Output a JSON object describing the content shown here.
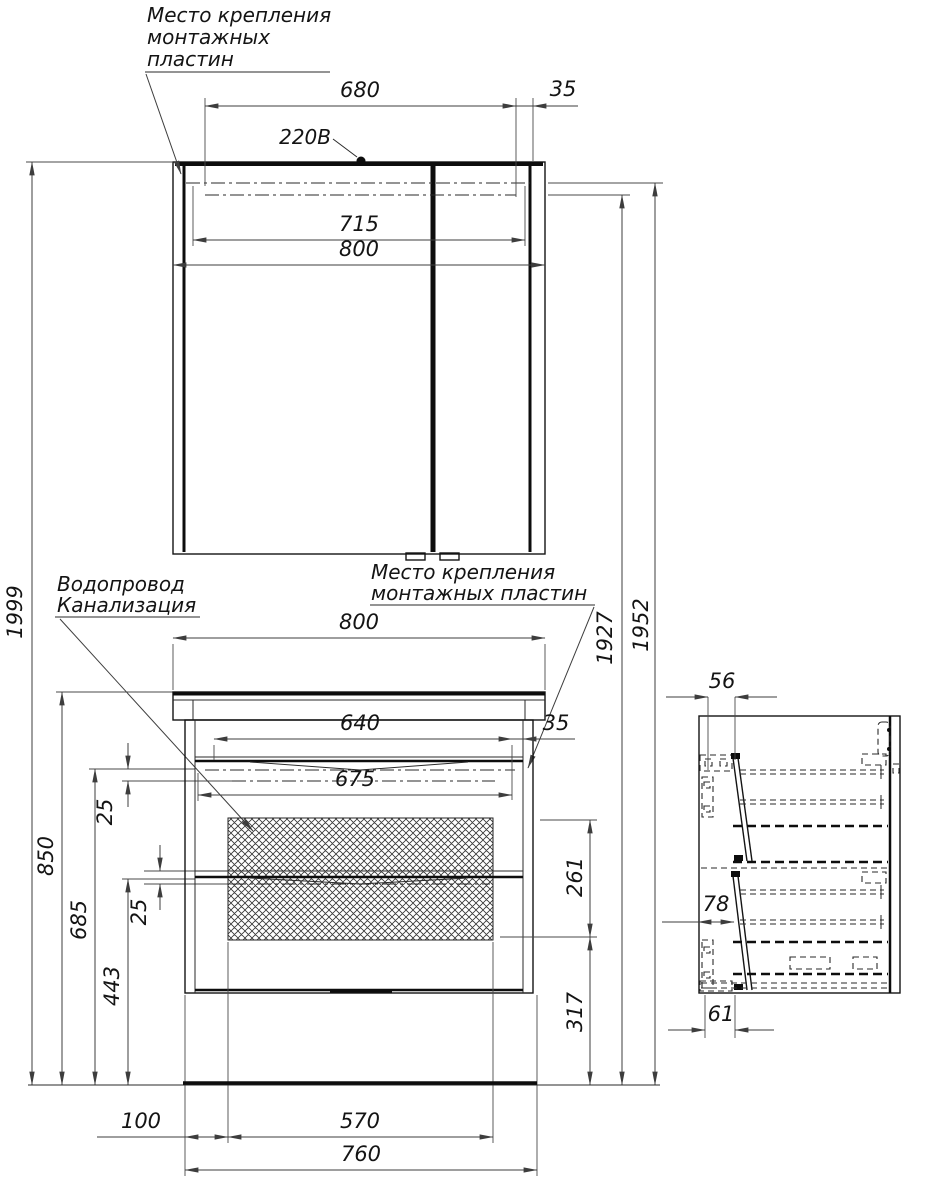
{
  "drawing": {
    "labels": {
      "mounting_plates_top": {
        "l1": "Место крепления",
        "l2": "монтажных",
        "l3": "пластин"
      },
      "voltage": "220В",
      "plumbing": {
        "l1": "Водопровод",
        "l2": "Канализация"
      },
      "mounting_plates_mid": {
        "l1": "Место крепления",
        "l2": "монтажных пластин"
      }
    },
    "mirror_dims": {
      "top_span": "680",
      "top_offset": "35",
      "inner_width": "715",
      "width": "800"
    },
    "vanity_dims": {
      "width": "800",
      "basin_width": "640",
      "side_offset": "35",
      "inner_width": "675",
      "plate_gap_top": "25",
      "plate_gap_mid": "25",
      "plate_zone": "261",
      "lower_zone": "317",
      "left_gap": "100",
      "plate_width": "570",
      "bottom_width": "760"
    },
    "height_dims": {
      "total": "1999",
      "counter_height": "850",
      "drawer_top": "685",
      "mid_rail": "443",
      "plates_low": "1927",
      "plates_high": "1952"
    },
    "side_dims": {
      "top_depth": "56",
      "mid_depth": "78",
      "bottom_depth": "61"
    },
    "colors": {
      "object_line": "#141414",
      "dimension_line": "#3d3d3d",
      "background": "#ffffff"
    }
  }
}
